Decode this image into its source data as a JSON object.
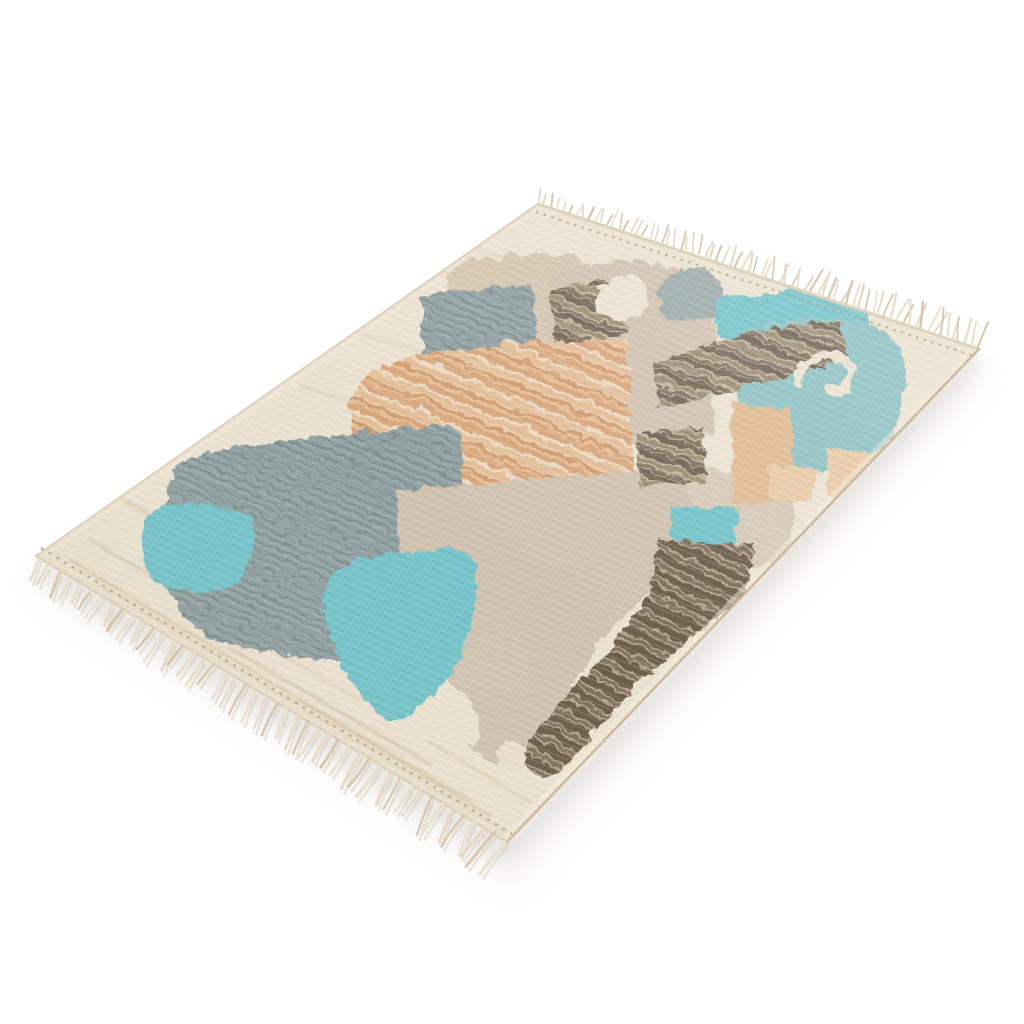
{
  "scene": {
    "subject": "Flat-woven kilim area rug with abstract pastel patchwork design and tasselled fringe, photographed at an angle on a white background"
  },
  "palette": {
    "background": "#FFFFFF",
    "rug_base": "#EEE5D4",
    "cream": "#EFE6D7",
    "white": "#FFFFFF",
    "taupe": "#D7C7B2",
    "greige": "#D2C4B2",
    "greige_light": "#D9CCBA",
    "slate": "#8FA0A3",
    "slate_light": "#9CABAD",
    "slate_dark": "#79898C",
    "teal": "#72C5CC",
    "teal_soft": "#8EC4C7",
    "tan": "#DBA87C",
    "tan_mid": "#E6BF97",
    "tan_deep": "#D49E6F",
    "tan_col": "#E2BC93",
    "peach": "#ECCDA8",
    "brown": "#6F6051",
    "brown_light": "#9A8971",
    "brown_mid": "#7E6E5C",
    "brown_dark": "#6B5B4A",
    "brown_gap": "#C3B29A",
    "brown_gap2": "#B3A28B",
    "stripe_gap": "#F0E3CD",
    "weft_dark": "#6B4F2E",
    "fringe": "#E9DECB",
    "fringe_light": "#E5D8C2",
    "fringe_shadow": "#D5C5AA",
    "knot": "#B99C74",
    "streak": "#D9C3A4",
    "streak_light": "#E4D4BC",
    "streak_dark": "#CDB391",
    "edge": "#DFD2BA",
    "edge_dark": "#CBBA9F",
    "edge_light": "#F3EBDC",
    "shadow": "#B7AFA2",
    "shadow_soft": "#C4BCAE"
  }
}
